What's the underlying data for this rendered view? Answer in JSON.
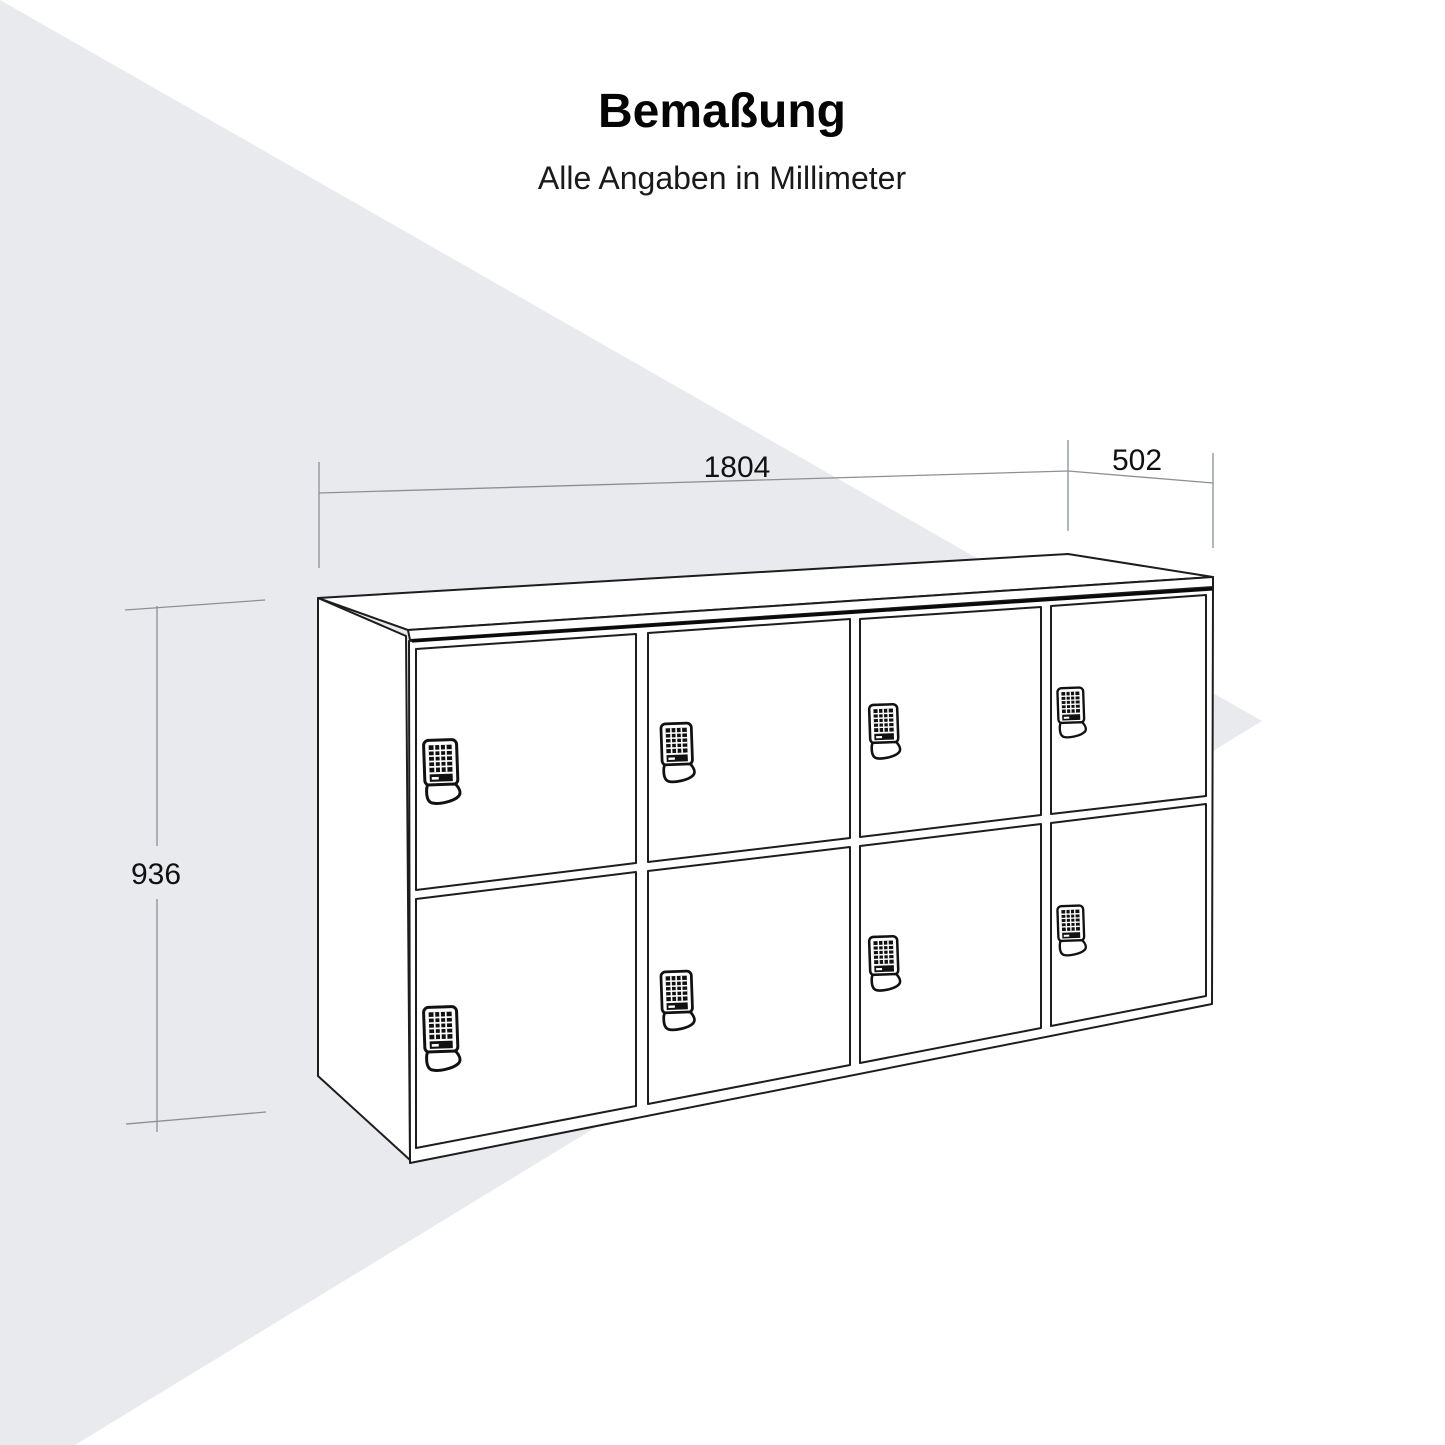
{
  "title": "Bemaßung",
  "subtitle": "Alle Angaben in Millimeter",
  "dimensions": {
    "width_mm": "1804",
    "depth_mm": "502",
    "height_mm": "936"
  },
  "cabinet": {
    "kind": "locker-sideboard-with-keypad-locks",
    "door_columns": 4,
    "door_rows": 2,
    "door_count": 8,
    "lock_icon": "keypad-lock-icon"
  },
  "colors": {
    "paper": "#ffffff",
    "accent-shape": "#e9eaed",
    "ink": "#1d1d1d",
    "ink-heavy": "#0a0a0a",
    "dim-line": "#8c9095",
    "text": "#111111"
  }
}
